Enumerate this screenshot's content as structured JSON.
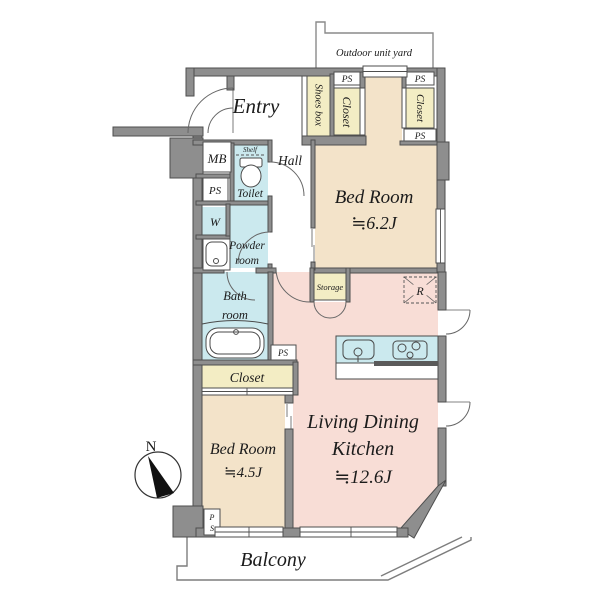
{
  "palette": {
    "wall_fill": "#8e8e8e",
    "wall_edge": "#4e4e4e",
    "bedroom_fill": "#f3e3c9",
    "ldk_fill": "#f8ddd6",
    "wet_area_fill": "#cbe9ee",
    "closet_fill": "#f3edc4",
    "line_color": "#555555"
  },
  "labels": {
    "outdoor_unit_yard": "Outdoor unit yard",
    "entry": "Entry",
    "shoes_box": "Shoes box",
    "ps": "PS",
    "closet": "Closet",
    "mb": "MB",
    "shelf": "Shelf",
    "toilet": "Toilet",
    "hall": "Hall",
    "washer": "W",
    "powder_room_line1": "Powder",
    "powder_room_line2": "room",
    "bath_room_line1": "Bath",
    "bath_room_line2": "room",
    "storage": "Storage",
    "refrigerator_mark": "R",
    "balcony": "Balcony",
    "north_mark": "N",
    "ps_vertical_p": "P",
    "ps_vertical_s": "S"
  },
  "rooms": {
    "bedroom_north": {
      "name": "Bed Room",
      "size": "≒6.2J"
    },
    "bedroom_south": {
      "name": "Bed Room",
      "size": "≒4.5J"
    },
    "living_dining_kitchen": {
      "line1": "Living Dining",
      "line2": "Kitchen",
      "size": "≒12.6J"
    }
  }
}
